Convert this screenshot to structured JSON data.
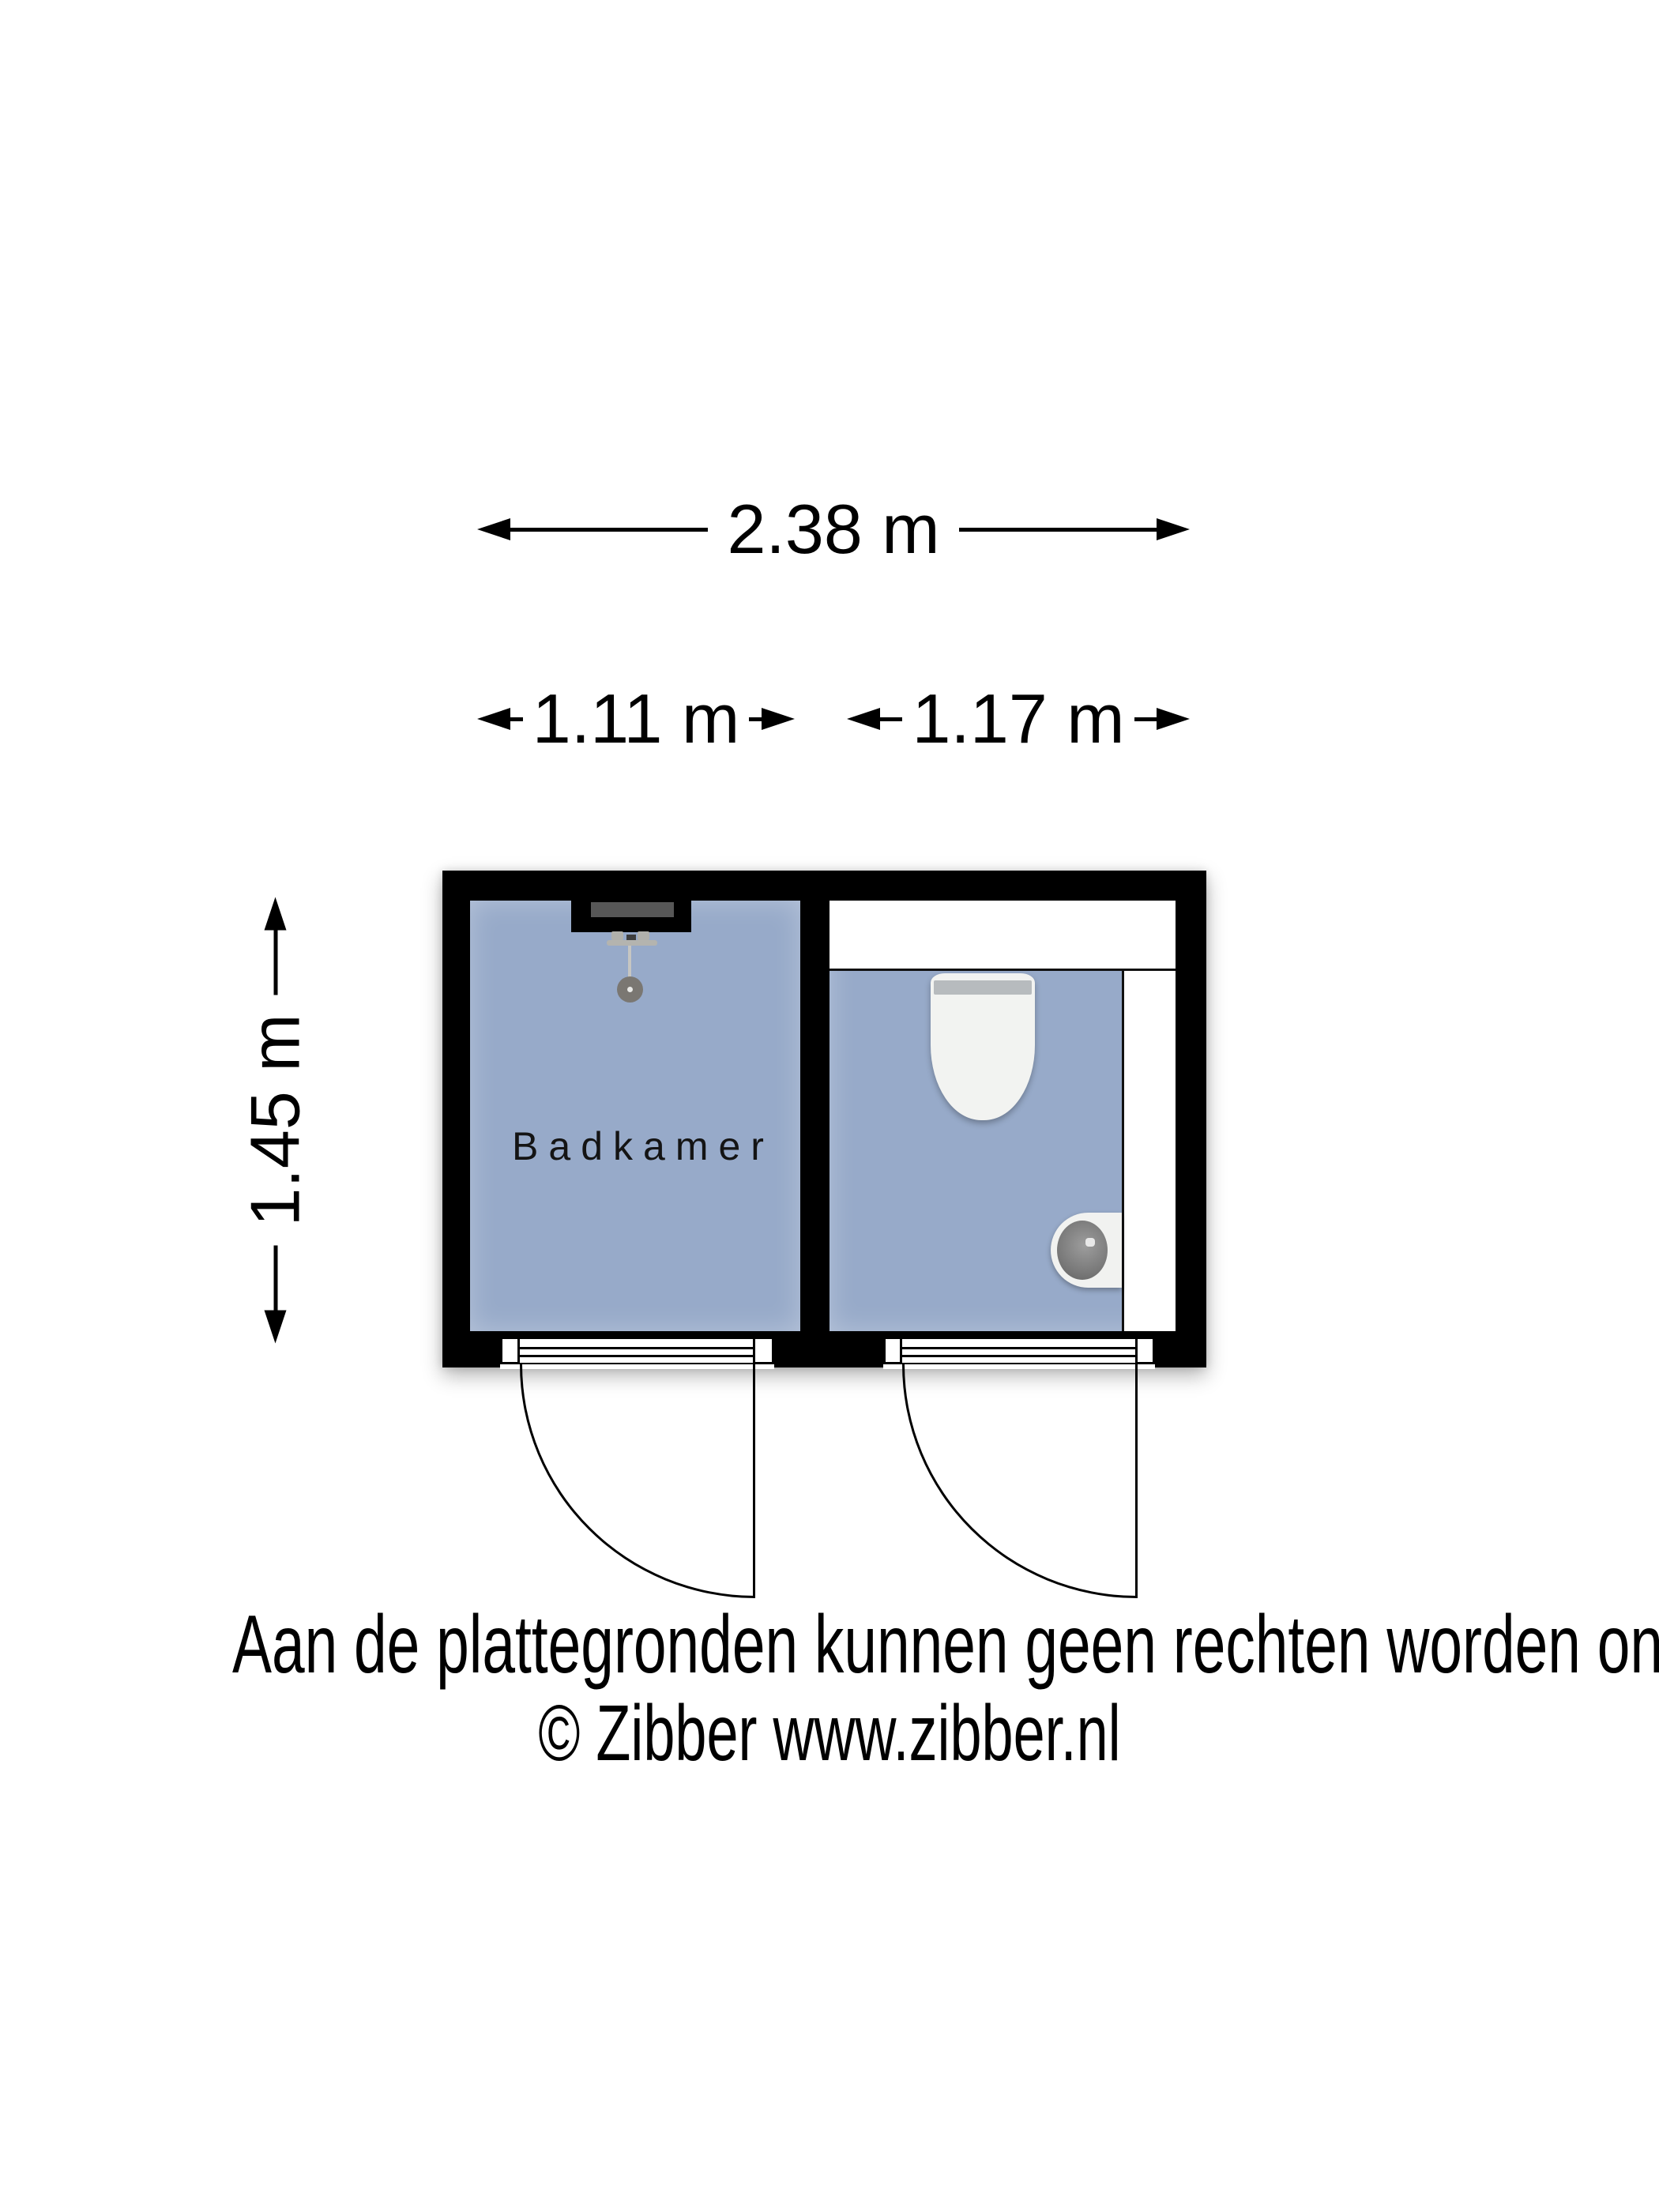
{
  "floorplan": {
    "type": "floor-plan",
    "dimensions": {
      "overall_width": "2.38 m",
      "bathroom_width": "1.11 m",
      "toilet_width": "1.17 m",
      "depth": "1.45 m"
    },
    "rooms": {
      "bathroom": {
        "label": "Badkamer",
        "fixtures": [
          "shower"
        ]
      },
      "toilet": {
        "label": "",
        "fixtures": [
          "toilet",
          "hand-basin",
          "shelf"
        ]
      }
    },
    "doors": 2,
    "colors": {
      "wall": "#000000",
      "floor": "#97aac9",
      "fixture_white": "#f2f3f1",
      "niche_gray": "#575757",
      "text": "#141414"
    }
  },
  "footer": {
    "disclaimer": "Aan de plattegronden kunnen geen rechten worden ontleend",
    "copyright": "© Zibber www.zibber.nl"
  }
}
